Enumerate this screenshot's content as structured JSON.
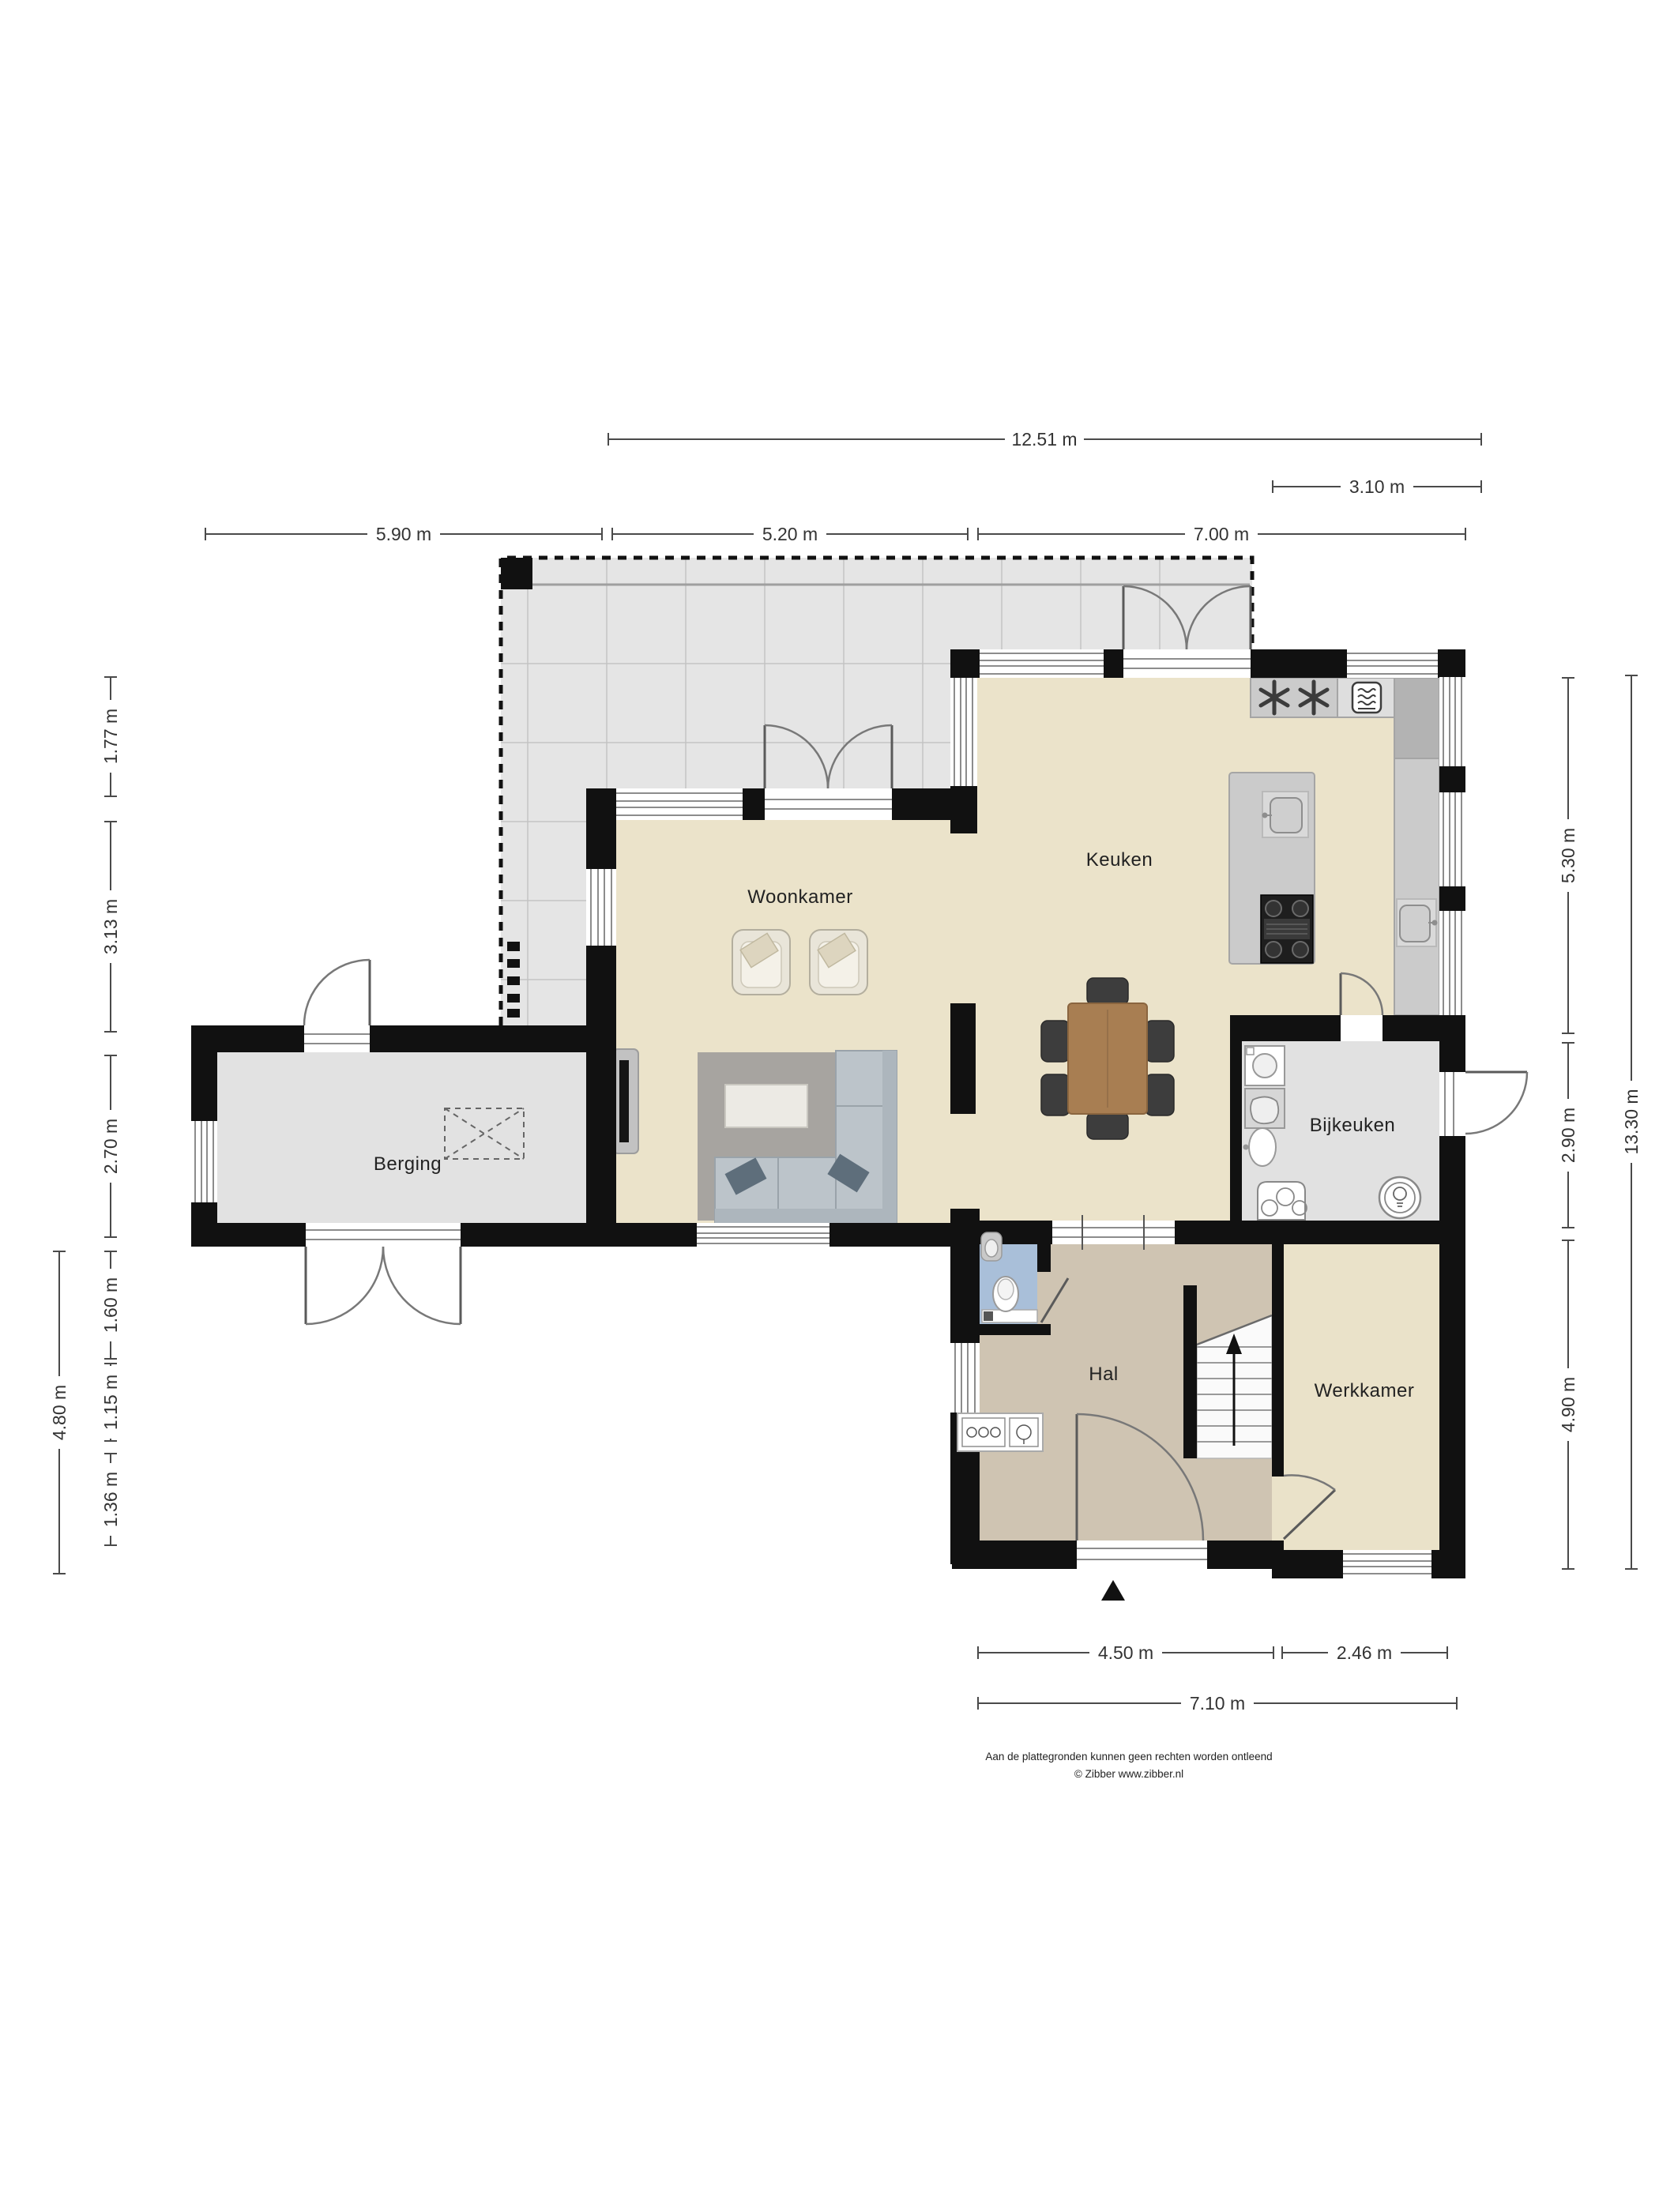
{
  "rooms": {
    "woonkamer": "Woonkamer",
    "keuken": "Keuken",
    "berging": "Berging",
    "bijkeuken": "Bijkeuken",
    "hal": "Hal",
    "werkkamer": "Werkkamer"
  },
  "dimensions": {
    "top": {
      "total": "12.51 m",
      "right_section": "3.10 m",
      "berging": "5.90 m",
      "woonkamer": "5.20 m",
      "keuken": "7.00 m"
    },
    "left": {
      "seg1": "1.77 m",
      "seg2": "3.13 m",
      "seg3": "2.70 m",
      "seg4": "1.60 m",
      "seg5": "1.15 m",
      "seg6": "1.36 m",
      "outer": "4.80 m"
    },
    "right": {
      "keuken": "5.30 m",
      "bijkeuken": "2.90 m",
      "werkkamer": "4.90 m",
      "total": "13.30 m"
    },
    "bottom": {
      "hal": "4.50 m",
      "werkkamer": "2.46 m",
      "total": "7.10 m"
    }
  },
  "footer": {
    "line1": "Aan de plattegronden kunnen geen rechten worden ontleend",
    "line2": "© Zibber www.zibber.nl"
  },
  "icons": {
    "entrance_marker": "entrance-triangle",
    "stairs_direction": "up-arrow",
    "kitchen_cooling": "asterisk-star",
    "kitchen_oven": "oven",
    "roof_light": "dashed-cross-rect"
  }
}
